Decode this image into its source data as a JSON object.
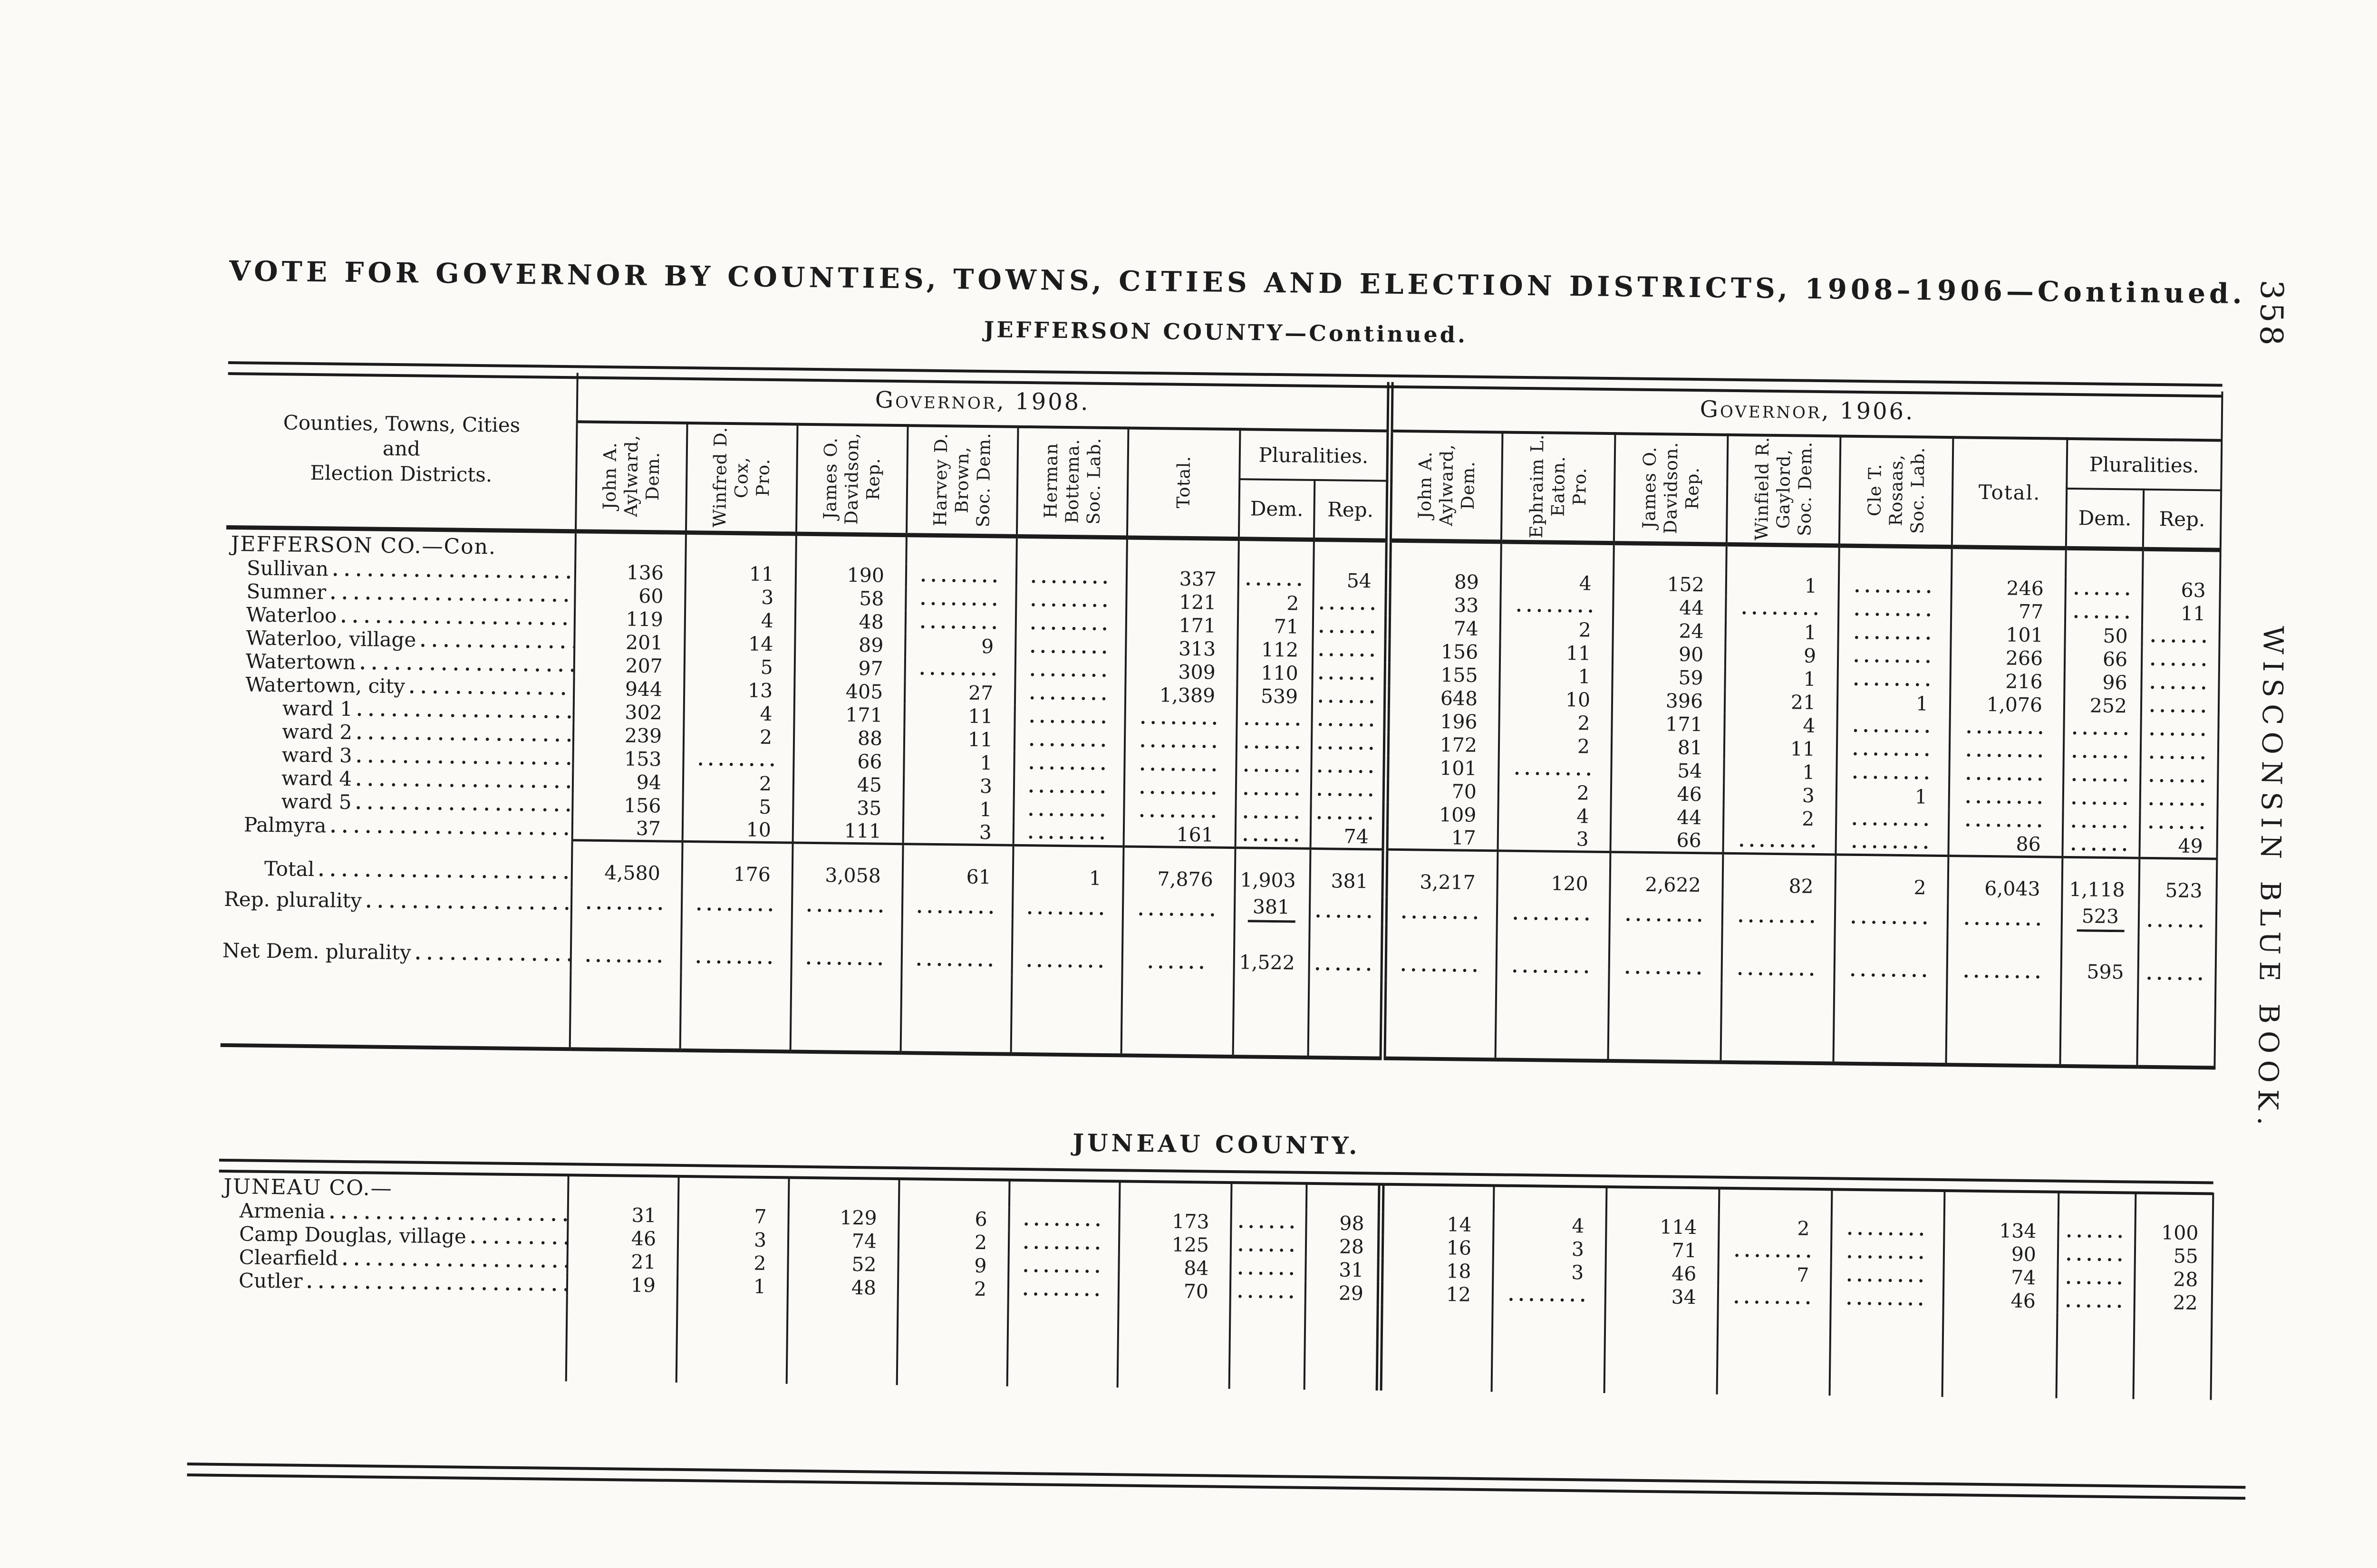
{
  "page": {
    "number": "358",
    "margin_title": "WISCONSIN BLUE BOOK."
  },
  "title": "VOTE FOR GOVERNOR BY COUNTIES, TOWNS, CITIES AND ELECTION DISTRICTS, 1908–1906—Continued.",
  "subtitle": "JEFFERSON COUNTY—Continued.",
  "header": {
    "row_label_lines": [
      "Counties, Towns, Cities",
      "and",
      "Election Districts."
    ],
    "groups": [
      {
        "title": "Governor, 1908.",
        "candidates": [
          [
            "John A.",
            "Aylward,",
            "Dem."
          ],
          [
            "Winfred D.",
            "Cox,",
            "Pro."
          ],
          [
            "James O.",
            "Davidson,",
            "Rep."
          ],
          [
            "Harvey D.",
            "Brown,",
            "Soc. Dem."
          ],
          [
            "Herman",
            "Bottema.",
            "Soc. Lab."
          ]
        ],
        "total_label": "Total.",
        "total_rotated": true,
        "pluralities_label": "Pluralities.",
        "plurality_cols": [
          "Dem.",
          "Rep."
        ]
      },
      {
        "title": "Governor, 1906.",
        "candidates": [
          [
            "John A.",
            "Aylward,",
            "Dem."
          ],
          [
            "Ephraim L.",
            "Eaton.",
            "Pro."
          ],
          [
            "James O.",
            "Davidson.",
            "Rep."
          ],
          [
            "Winfield R.",
            "Gaylord,",
            "Soc. Dem."
          ],
          [
            "Cle T.",
            "Rosaas,",
            "Soc. Lab."
          ]
        ],
        "total_label": "Total.",
        "total_rotated": false,
        "pluralities_label": "Pluralities.",
        "plurality_cols": [
          "Dem.",
          "Rep."
        ]
      }
    ]
  },
  "jefferson": {
    "rows": [
      {
        "type": "section",
        "label": "JEFFERSON CO.—Con.",
        "cells": [
          "",
          "",
          "",
          "",
          "",
          "",
          "",
          "",
          "",
          "",
          "",
          "",
          "",
          "",
          "",
          ""
        ]
      },
      {
        "type": "item",
        "label": "Sullivan",
        "cells": [
          "136",
          "11",
          "190",
          "........",
          "........",
          "337",
          "......",
          "54",
          "89",
          "4",
          "152",
          "1",
          "........",
          "246",
          "......",
          "63"
        ]
      },
      {
        "type": "item",
        "label": "Sumner",
        "cells": [
          "60",
          "3",
          "58",
          "........",
          "........",
          "121",
          "2",
          "......",
          "33",
          "........",
          "44",
          "........",
          "........",
          "77",
          "......",
          "11"
        ]
      },
      {
        "type": "item",
        "label": "Waterloo",
        "cells": [
          "119",
          "4",
          "48",
          "........",
          "........",
          "171",
          "71",
          "......",
          "74",
          "2",
          "24",
          "1",
          "........",
          "101",
          "50",
          "......"
        ]
      },
      {
        "type": "item",
        "label": "Waterloo, village",
        "cells": [
          "201",
          "14",
          "89",
          "9",
          "........",
          "313",
          "112",
          "......",
          "156",
          "11",
          "90",
          "9",
          "........",
          "266",
          "66",
          "......"
        ]
      },
      {
        "type": "item",
        "label": "Watertown",
        "cells": [
          "207",
          "5",
          "97",
          "........",
          "........",
          "309",
          "110",
          "......",
          "155",
          "1",
          "59",
          "1",
          "........",
          "216",
          "96",
          "......"
        ]
      },
      {
        "type": "item",
        "label": "Watertown, city",
        "cells": [
          "944",
          "13",
          "405",
          "27",
          "........",
          "1,389",
          "539",
          "......",
          "648",
          "10",
          "396",
          "21",
          "1",
          "1,076",
          "252",
          "......"
        ]
      },
      {
        "type": "ward",
        "label": "ward 1",
        "cells": [
          "302",
          "4",
          "171",
          "11",
          "........",
          "........",
          "......",
          "......",
          "196",
          "2",
          "171",
          "4",
          "........",
          "........",
          "......",
          "......"
        ]
      },
      {
        "type": "ward",
        "label": "ward 2",
        "cells": [
          "239",
          "2",
          "88",
          "11",
          "........",
          "........",
          "......",
          "......",
          "172",
          "2",
          "81",
          "11",
          "........",
          "........",
          "......",
          "......"
        ]
      },
      {
        "type": "ward",
        "label": "ward 3",
        "cells": [
          "153",
          "........",
          "66",
          "1",
          "........",
          "........",
          "......",
          "......",
          "101",
          "........",
          "54",
          "1",
          "........",
          "........",
          "......",
          "......"
        ]
      },
      {
        "type": "ward",
        "label": "ward 4",
        "cells": [
          "94",
          "2",
          "45",
          "3",
          "........",
          "........",
          "......",
          "......",
          "70",
          "2",
          "46",
          "3",
          "1",
          "........",
          "......",
          "......"
        ]
      },
      {
        "type": "ward",
        "label": "ward 5",
        "cells": [
          "156",
          "5",
          "35",
          "1",
          "........",
          "........",
          "......",
          "......",
          "109",
          "4",
          "44",
          "2",
          "........",
          "........",
          "......",
          "......"
        ]
      },
      {
        "type": "item",
        "label": "Palmyra",
        "cells": [
          "37",
          "10",
          "111",
          "3",
          "........",
          "161",
          "......",
          "74",
          "17",
          "3",
          "66",
          "........",
          "........",
          "86",
          "......",
          "49"
        ]
      },
      {
        "type": "total",
        "label": "Total",
        "cells": [
          "4,580",
          "176",
          "3,058",
          "61",
          "1",
          "7,876",
          "1,903",
          "381",
          "3,217",
          "120",
          "2,622",
          "82",
          "2",
          "6,043",
          "1,118",
          "523"
        ]
      },
      {
        "type": "plur",
        "label": "Rep. plurality",
        "cells": [
          "........",
          "........",
          "........",
          "........",
          "........",
          "........",
          "381",
          "......",
          "........",
          "........",
          "........",
          "........",
          "........",
          "........",
          "523",
          "......"
        ]
      },
      {
        "type": "net",
        "label": "Net Dem. plurality",
        "cells": [
          "........",
          "........",
          "........",
          "........",
          "........",
          "......",
          "1,522",
          "......",
          "........",
          "........",
          "........",
          "........",
          "........",
          "........",
          "595",
          "......"
        ]
      }
    ]
  },
  "juneau": {
    "heading": "JUNEAU COUNTY.",
    "rows": [
      {
        "type": "section",
        "label": "JUNEAU CO.—",
        "cells": [
          "",
          "",
          "",
          "",
          "",
          "",
          "",
          "",
          "",
          "",
          "",
          "",
          "",
          "",
          "",
          ""
        ]
      },
      {
        "type": "item",
        "label": "Armenia",
        "cells": [
          "31",
          "7",
          "129",
          "6",
          "........",
          "173",
          "......",
          "98",
          "14",
          "4",
          "114",
          "2",
          "........",
          "134",
          "......",
          "100"
        ]
      },
      {
        "type": "item",
        "label": "Camp Douglas, village",
        "cells": [
          "46",
          "3",
          "74",
          "2",
          "........",
          "125",
          "......",
          "28",
          "16",
          "3",
          "71",
          "........",
          "........",
          "90",
          "......",
          "55"
        ]
      },
      {
        "type": "item",
        "label": "Clearfield",
        "cells": [
          "21",
          "2",
          "52",
          "9",
          "........",
          "84",
          "......",
          "31",
          "18",
          "3",
          "46",
          "7",
          "........",
          "74",
          "......",
          "28"
        ]
      },
      {
        "type": "item",
        "label": "Cutler",
        "cells": [
          "19",
          "1",
          "48",
          "2",
          "........",
          "70",
          "......",
          "29",
          "12",
          "........",
          "34",
          "........",
          "........",
          "46",
          "......",
          "22"
        ]
      }
    ]
  }
}
